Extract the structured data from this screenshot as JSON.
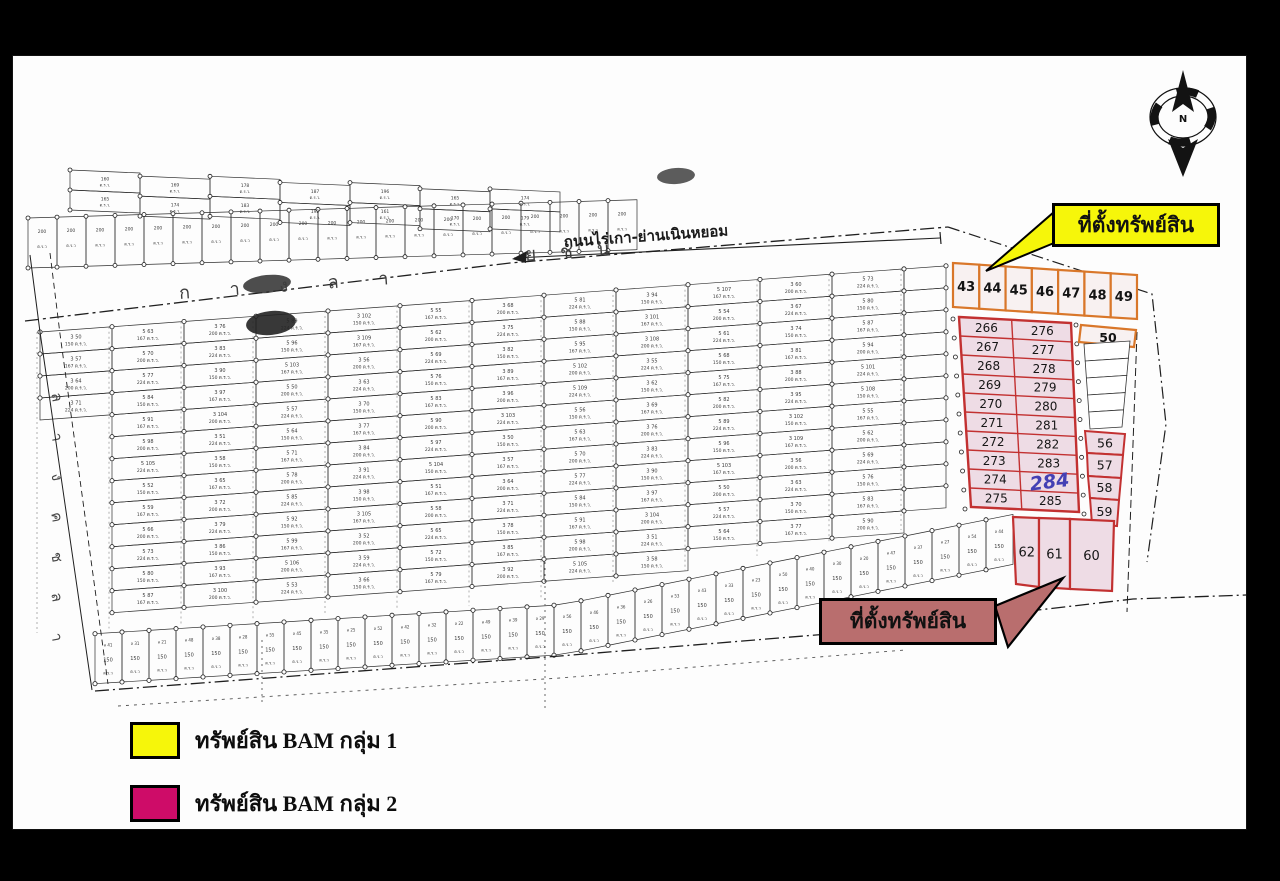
{
  "compass": {
    "north_label": "N"
  },
  "map": {
    "road_label": "ถนนไร่เกา-ย่านเนินหยอม",
    "spaced_road_letters": "ก า ง ล า",
    "spaced_road_letters_2": "ย ช น",
    "canal_letters": [
      "ล",
      "า",
      "ง",
      "ค",
      "ช",
      "ล",
      "า"
    ],
    "texture_area_labels": [
      "150 ต.ร.ว.",
      "167 ต.ร.ว.",
      "200 ต.ร.ว.",
      "224 ต.ร.ว."
    ]
  },
  "plots": {
    "group1_row": [
      "43",
      "44",
      "45",
      "46",
      "47",
      "48",
      "49"
    ],
    "group1_extra": "50",
    "group2_grid_left": [
      "266",
      "267",
      "268",
      "269",
      "270",
      "271",
      "272",
      "273",
      "274",
      "275"
    ],
    "group2_grid_right": [
      "276",
      "277",
      "278",
      "279",
      "280",
      "281",
      "282",
      "283",
      "284",
      "285"
    ],
    "handwritten_plot": "284",
    "group2_right_column": [
      "56",
      "57",
      "58",
      "59"
    ],
    "group2_bottom_row": [
      "62",
      "61",
      "60"
    ]
  },
  "callouts": {
    "top": {
      "text": "ที่ตั้งทรัพย์สิน"
    },
    "bottom": {
      "text": "ที่ตั้งทรัพย์สิน"
    }
  },
  "legend": {
    "items": [
      {
        "label": "ทรัพย์สิน BAM กลุ่ม 1",
        "color": "#f6f60a"
      },
      {
        "label": "ทรัพย์สิน BAM กลุ่ม 2",
        "color": "#ce0c68"
      }
    ]
  },
  "colors": {
    "group1_border": "#d9772a",
    "group1_fill": "#f8f1f1",
    "group2_border": "#c23131",
    "group2_fill": "#eedce5",
    "handwritten_blue": "#4440b4",
    "callout_top_fill": "#f6f60a",
    "callout_bottom_fill": "#b96e6e"
  }
}
